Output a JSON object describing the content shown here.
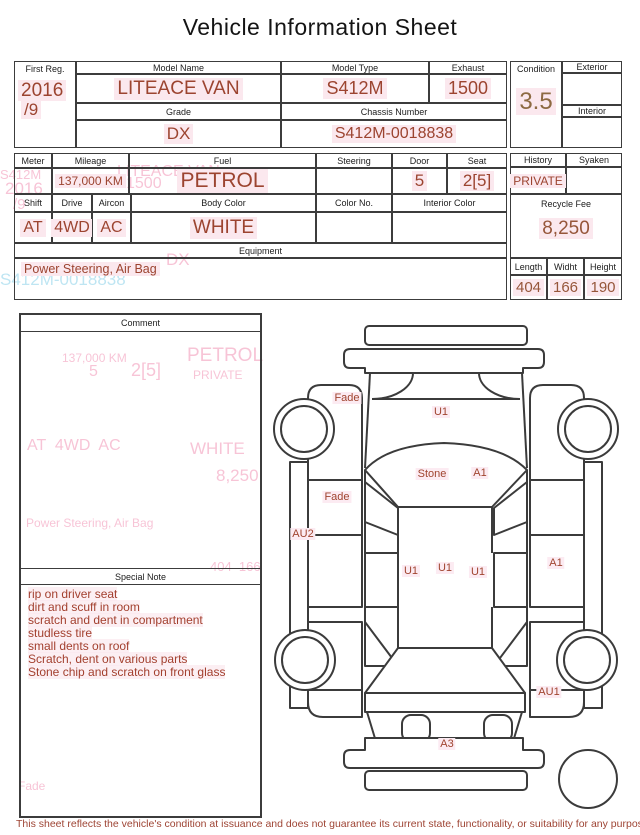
{
  "title": "Vehicle Information Sheet",
  "info": {
    "first_reg": {
      "label": "First Reg.",
      "value_top": "2016",
      "value_bottom": "/9"
    },
    "model_name": {
      "label": "Model Name",
      "value": "LITEACE VAN"
    },
    "model_type": {
      "label": "Model Type",
      "value": "S412M"
    },
    "exhaust": {
      "label": "Exhaust",
      "value": "1500"
    },
    "grade": {
      "label": "Grade",
      "value": "DX"
    },
    "chassis_number": {
      "label": "Chassis Number",
      "value": "S412M-0018838"
    },
    "condition": {
      "label": "Condition",
      "value": "3.5"
    },
    "exterior": {
      "label": "Exterior",
      "value": ""
    },
    "interior": {
      "label": "Interior",
      "value": ""
    },
    "meter": {
      "label": "Meter",
      "value": ""
    },
    "mileage": {
      "label": "Mileage",
      "value": "137,000 KM"
    },
    "fuel": {
      "label": "Fuel",
      "value": "PETROL"
    },
    "steering": {
      "label": "Steering",
      "value": ""
    },
    "door": {
      "label": "Door",
      "value": "5"
    },
    "seat": {
      "label": "Seat",
      "value": "2[5]"
    },
    "history": {
      "label": "History",
      "value": "PRIVATE"
    },
    "syaken": {
      "label": "Syaken",
      "value": ""
    },
    "shift": {
      "label": "Shift",
      "value": "AT"
    },
    "drive": {
      "label": "Drive",
      "value": "4WD"
    },
    "aircon": {
      "label": "Aircon",
      "value": "AC"
    },
    "body_color": {
      "label": "Body Color",
      "value": "WHITE"
    },
    "color_no": {
      "label": "Color No.",
      "value": ""
    },
    "interior_color": {
      "label": "Interior Color",
      "value": ""
    },
    "recycle_fee": {
      "label": "Recycle Fee",
      "value": "8,250"
    },
    "length": {
      "label": "Length",
      "value": "404"
    },
    "width": {
      "label": "Widht",
      "value": "166"
    },
    "height": {
      "label": "Height",
      "value": "190"
    },
    "equipment": {
      "label": "Equipment",
      "value": "Power Steering, Air Bag"
    }
  },
  "comment": {
    "label": "Comment",
    "value": ""
  },
  "special_note": {
    "label": "Special Note",
    "lines": [
      "rip on driver seat",
      "dirt and scuff in room",
      "scratch and dent in compartment",
      "studless tire",
      "small dents on roof",
      "Scratch, dent on various parts",
      "Stone chip and scratch on front glass"
    ]
  },
  "diagram": {
    "marks": [
      "Fade",
      "U1",
      "Stone",
      "A1",
      "Fade",
      "AU2",
      "U1",
      "U1",
      "U1",
      "A1",
      "AU1",
      "A3"
    ]
  },
  "ghost_texts": [
    "S412M",
    "2016",
    "/9",
    "LITEACE VAN",
    "1500",
    "DX",
    "S412M-0018838",
    "137,000 KM",
    "PETROL",
    "5",
    "2[5]",
    "PRIVATE",
    "AT  4WD  AC",
    "WHITE",
    "8,250",
    "Power Steering, Air Bag",
    "404  166",
    "Fade"
  ],
  "footer": {
    "disclaimer": "This sheet reflects the vehicle's condition at issuance and does not guarantee its current state, functionality, or suitability for any purpose"
  },
  "colors": {
    "value_red": "#9c4430",
    "condition_brown": "#8d6a42",
    "dimension_tan": "#96563a",
    "highlight_pink": "#fbe8ee",
    "line": "#3c3c3c",
    "ghost_pink": "#f6b6cd",
    "ghost_blue": "#aedff0"
  }
}
